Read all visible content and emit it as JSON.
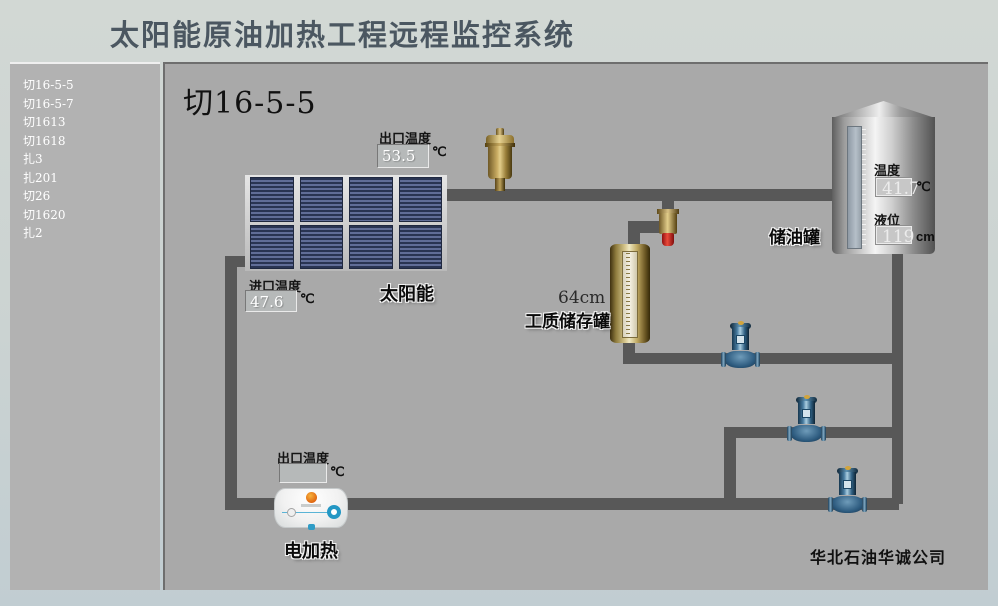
{
  "window": {
    "title": "太阳能原油加热工程远程监控系统"
  },
  "sidebar": {
    "items": [
      {
        "label": "切16-5-5"
      },
      {
        "label": "切16-5-7"
      },
      {
        "label": "切1613"
      },
      {
        "label": "切1618"
      },
      {
        "label": "扎3"
      },
      {
        "label": "扎201"
      },
      {
        "label": "切26"
      },
      {
        "label": "切1620"
      },
      {
        "label": "扎2"
      }
    ]
  },
  "main": {
    "page_title": "切16-5-5",
    "company": "华北石油华诚公司",
    "solar": {
      "label": "太阳能",
      "outlet_temp": {
        "label": "出口温度",
        "value": "53.5",
        "unit": "℃"
      },
      "inlet_temp": {
        "label": "进口温度",
        "value": "47.6",
        "unit": "℃"
      }
    },
    "heater": {
      "label": "电加热",
      "outlet_temp": {
        "label": "出口温度",
        "value": "",
        "unit": "℃"
      }
    },
    "medium_tank": {
      "label": "工质储存罐",
      "level_text": "64cm"
    },
    "oil_tank": {
      "label": "储油罐",
      "temperature": {
        "label": "温度",
        "value": "41.7",
        "unit": "℃"
      },
      "level": {
        "label": "液位",
        "value": "119",
        "unit": "cm"
      }
    }
  },
  "colors": {
    "pipe": "#585858",
    "main_bg": "#a9a9a9",
    "sidebar_bg": "#b2b2b2",
    "page_bg": "#cbd3d2",
    "title_text": "#4b5761",
    "panel_blue": "#3d4a6e",
    "brass": "#c9ac62",
    "pump_blue": "#2e5c80",
    "valve_cap_red": "#cc2222"
  }
}
